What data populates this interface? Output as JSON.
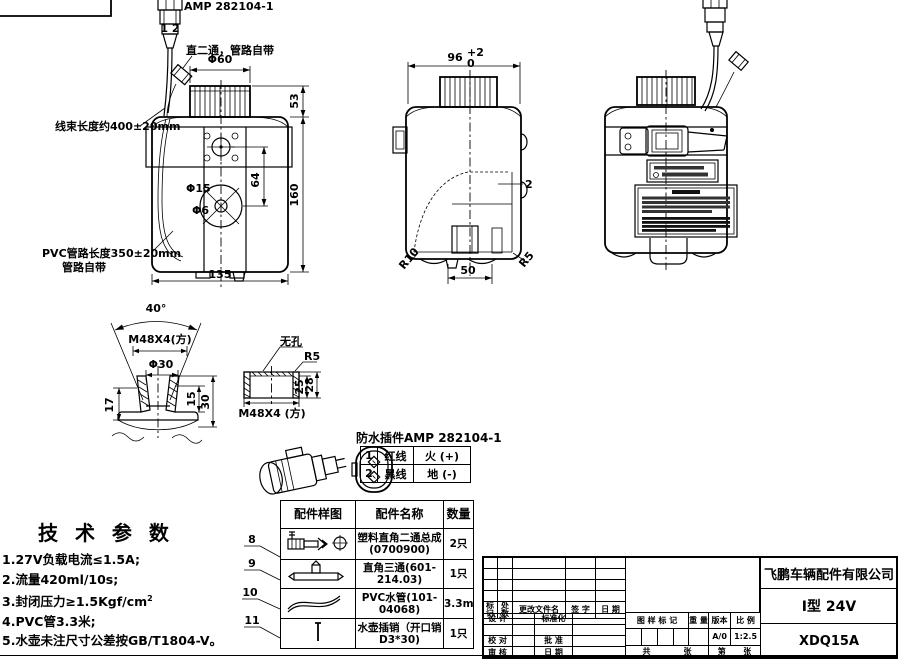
{
  "front_view": {
    "connector_label": "AMP 282104-1",
    "connector_pins": "1 2",
    "fitting_note": "直二通，管路自带",
    "harness_note": "线束长度约400±20mm",
    "pvc_note_line1": "PVC管路长度350±20mm",
    "pvc_note_line2": "管路自带",
    "dim_cap_dia": "Φ60",
    "dim_cap_h": "53",
    "dim_height": "160",
    "dim_hole_span": "64",
    "dim_pump_dia": "Φ15",
    "dim_shaft_dia": "Φ6",
    "dim_width": "135"
  },
  "side_view": {
    "dim_width": "96",
    "dim_width_tol_up": "+2",
    "dim_width_tol_dn": "0",
    "dim_wall": "2",
    "dim_foot_span": "50",
    "dim_r_left": "R10",
    "dim_r_right": "R5"
  },
  "flange_section": {
    "dim_angle": "40°",
    "thread": "M48X4(方)",
    "dim_dia": "Φ30",
    "dim_depth": "17",
    "dim_inner_h": "15",
    "dim_total_h": "30"
  },
  "cap_section": {
    "note_no_hole": "无孔",
    "dim_r": "R5",
    "dim_inner_h": "25",
    "dim_total_h": "28",
    "thread": "M48X4 (方)"
  },
  "connector_detail": {
    "title": "防水插件AMP 282104-1",
    "rows": [
      {
        "no": "1",
        "wire": "红线",
        "signal": "火 (+)"
      },
      {
        "no": "2",
        "wire": "黑线",
        "signal": "地 (-)"
      }
    ]
  },
  "parts_table": {
    "col_sample": "配件样图",
    "col_name": "配件名称",
    "col_qty": "数量",
    "rows": [
      {
        "item": "8",
        "name_line1": "塑料直角二通总成",
        "name_line2": "(0700900)",
        "qty": "2只"
      },
      {
        "item": "9",
        "name_line1": "直角三通(601-214.03)",
        "name_line2": "",
        "qty": "1只"
      },
      {
        "item": "10",
        "name_line1": "PVC水管(101-04068)",
        "name_line2": "",
        "qty": "3.3m"
      },
      {
        "item": "11",
        "name_line1": "水壶插销（开口销",
        "name_line2": "D3*30)",
        "qty": "1只"
      }
    ]
  },
  "tech_params": {
    "title": "技 术 参 数",
    "item1": "1.27V负载电流≤1.5A;",
    "item2": "2.流量420ml/10s;",
    "item3": "3.封闭压力≥1.5Kgf/cm",
    "item3_sup": "2",
    "item4": "4.PVC管3.3米;",
    "item5": "5.水壶未注尺寸公差按GB/T1804-V。"
  },
  "title_block": {
    "company": "飞鹏车辆配件有限公司",
    "model": "I型 24V",
    "part_no": "XDQ15A",
    "rev_mark": "标记",
    "rev_count": "处数",
    "rev_file": "更改文件名",
    "rev_sign": "签 字",
    "rev_date": "日 期",
    "design": "设 计",
    "standardize": "标准化",
    "proofread": "校 对",
    "approve": "批 准",
    "review": "审 核",
    "date": "日 期",
    "drawing_mark": "图 样 标 记",
    "weight": "重 量",
    "version_label": "版本",
    "scale_label": "比 例",
    "version": "A/0",
    "scale": "1:2.5",
    "total_label": "共",
    "total_sheet": "张",
    "page_label": "第",
    "page_sheet": "张"
  }
}
